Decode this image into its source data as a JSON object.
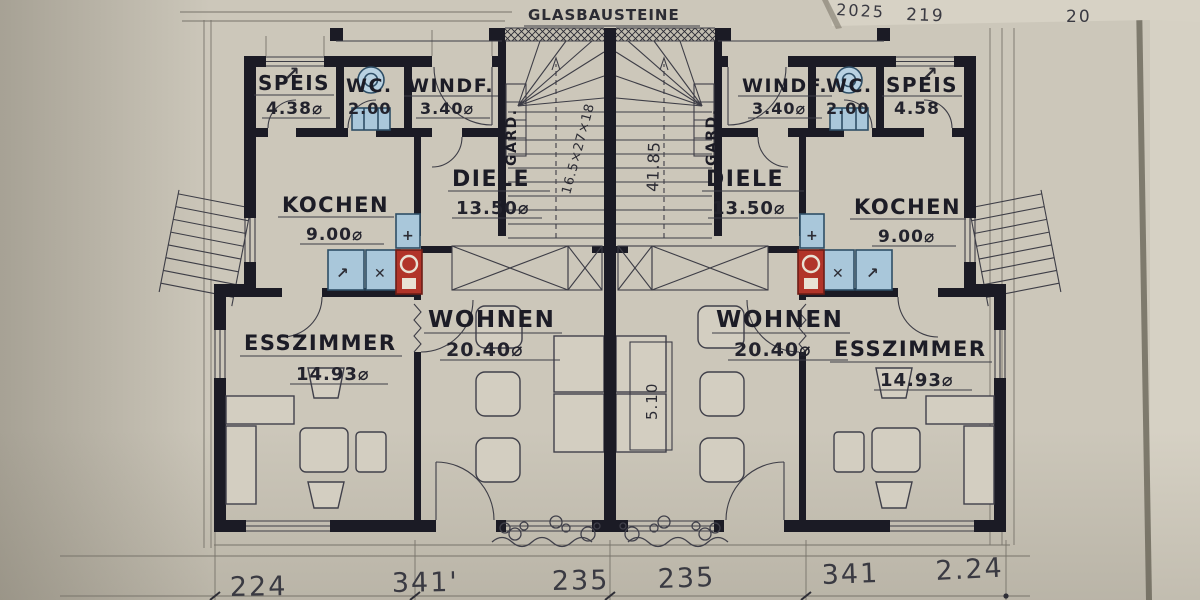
{
  "plan": {
    "glass_label": "GLASBAUSTEINE",
    "sheet": {
      "n1": "2025",
      "n2": "219",
      "n3": "20"
    },
    "left": {
      "speis": {
        "name": "SPEIS",
        "area": "4.38⌀"
      },
      "wc": {
        "name": "WC.",
        "area": "2.00"
      },
      "windf": {
        "name": "WINDF.",
        "area": "3.40⌀"
      },
      "gard": {
        "name": "GARD."
      },
      "diele": {
        "name": "DIELE",
        "area": "13.50⌀"
      },
      "kueche": {
        "name": "KOCHEN",
        "area": "9.00⌀"
      },
      "wohnen": {
        "name": "WOHNEN",
        "area": "20.40⌀"
      },
      "esszimmer": {
        "name": "ESSZIMMER",
        "area": "14.93⌀"
      }
    },
    "right": {
      "windf": {
        "name": "WINDF.",
        "area": "3.40⌀"
      },
      "wc": {
        "name": "WC.",
        "area": "2.00"
      },
      "speis": {
        "name": "SPEIS",
        "area": "4.58"
      },
      "gard": {
        "name": "GARD."
      },
      "diele": {
        "name": "DIELE",
        "area": "13.50⌀"
      },
      "kueche": {
        "name": "KOCHEN",
        "area": "9.00⌀"
      },
      "wohnen": {
        "name": "WOHNEN",
        "area": "20.40⌀"
      },
      "esszimmer": {
        "name": "ESSZIMMER",
        "area": "14.93⌀"
      }
    },
    "stair": {
      "steps": "16.5×27×18",
      "length": "41.85",
      "center_width": "5.10"
    },
    "dims": [
      "224",
      "341'",
      "235",
      "235",
      "341",
      "2.24"
    ],
    "symbols": {
      "arrow": "↗",
      "cross": "✕",
      "plus": "+"
    },
    "colors": {
      "paper": "#ccc7ba",
      "ink": "#1b1b25",
      "fixture_blue": "#a9c7da",
      "stove_red": "#b13429"
    }
  }
}
